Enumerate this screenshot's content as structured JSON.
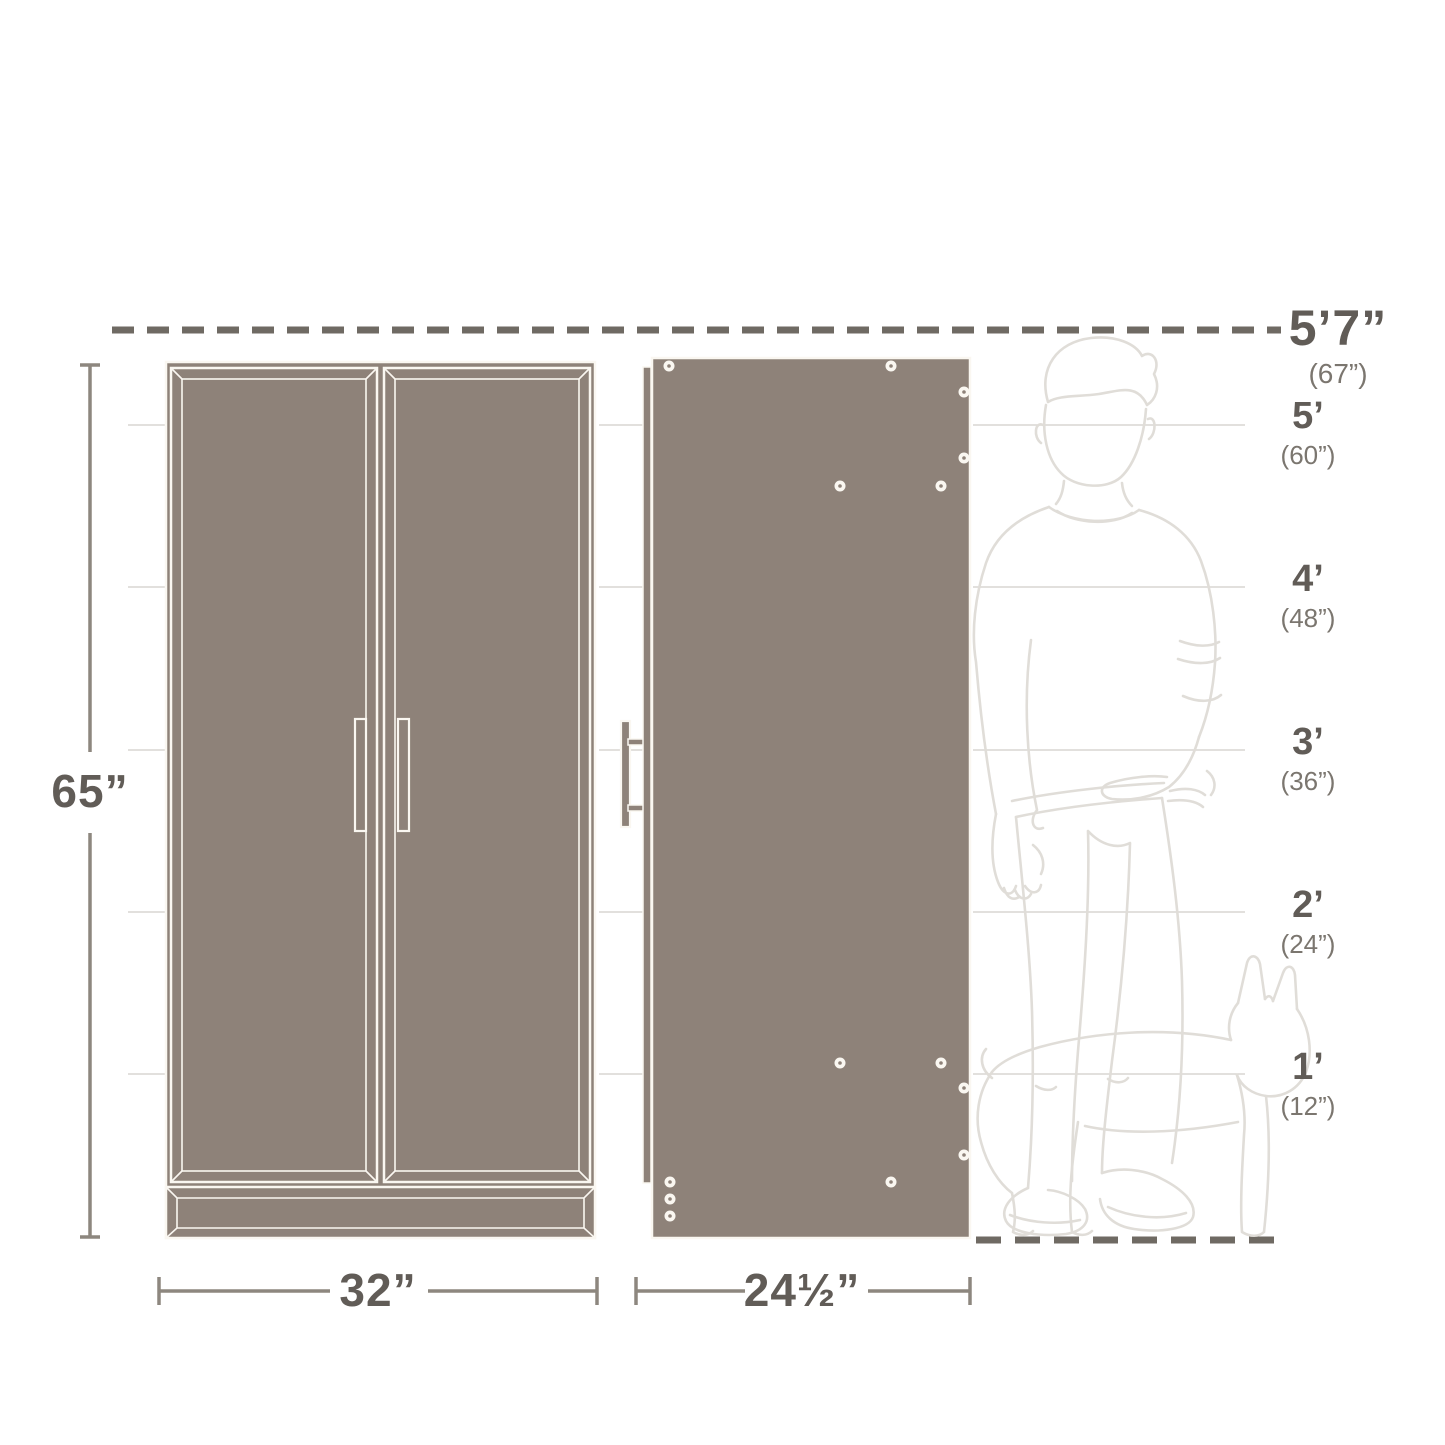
{
  "title": "Cabinet dimensions diagram",
  "dimensions": {
    "height": "65”",
    "width": "32”",
    "depth": "24½”"
  },
  "height_scale": {
    "max_label": "5’7”",
    "max_sub": "(67”)",
    "markers": [
      {
        "label": "5’",
        "sub": "(60”)"
      },
      {
        "label": "4’",
        "sub": "(48”)"
      },
      {
        "label": "3’",
        "sub": "(36”)"
      },
      {
        "label": "2’",
        "sub": "(24”)"
      },
      {
        "label": "1’",
        "sub": "(12”)"
      }
    ]
  },
  "colors": {
    "taupe": "#8E8279",
    "outline": "#FAF7F1",
    "dash": "#6F6A63",
    "dim": "#8D877F",
    "grid": "#D9D6D2",
    "fig": "#E0DDD8",
    "text_dark": "#615C57",
    "text_sub": "#7B766F",
    "bg": "#FFFFFF"
  }
}
